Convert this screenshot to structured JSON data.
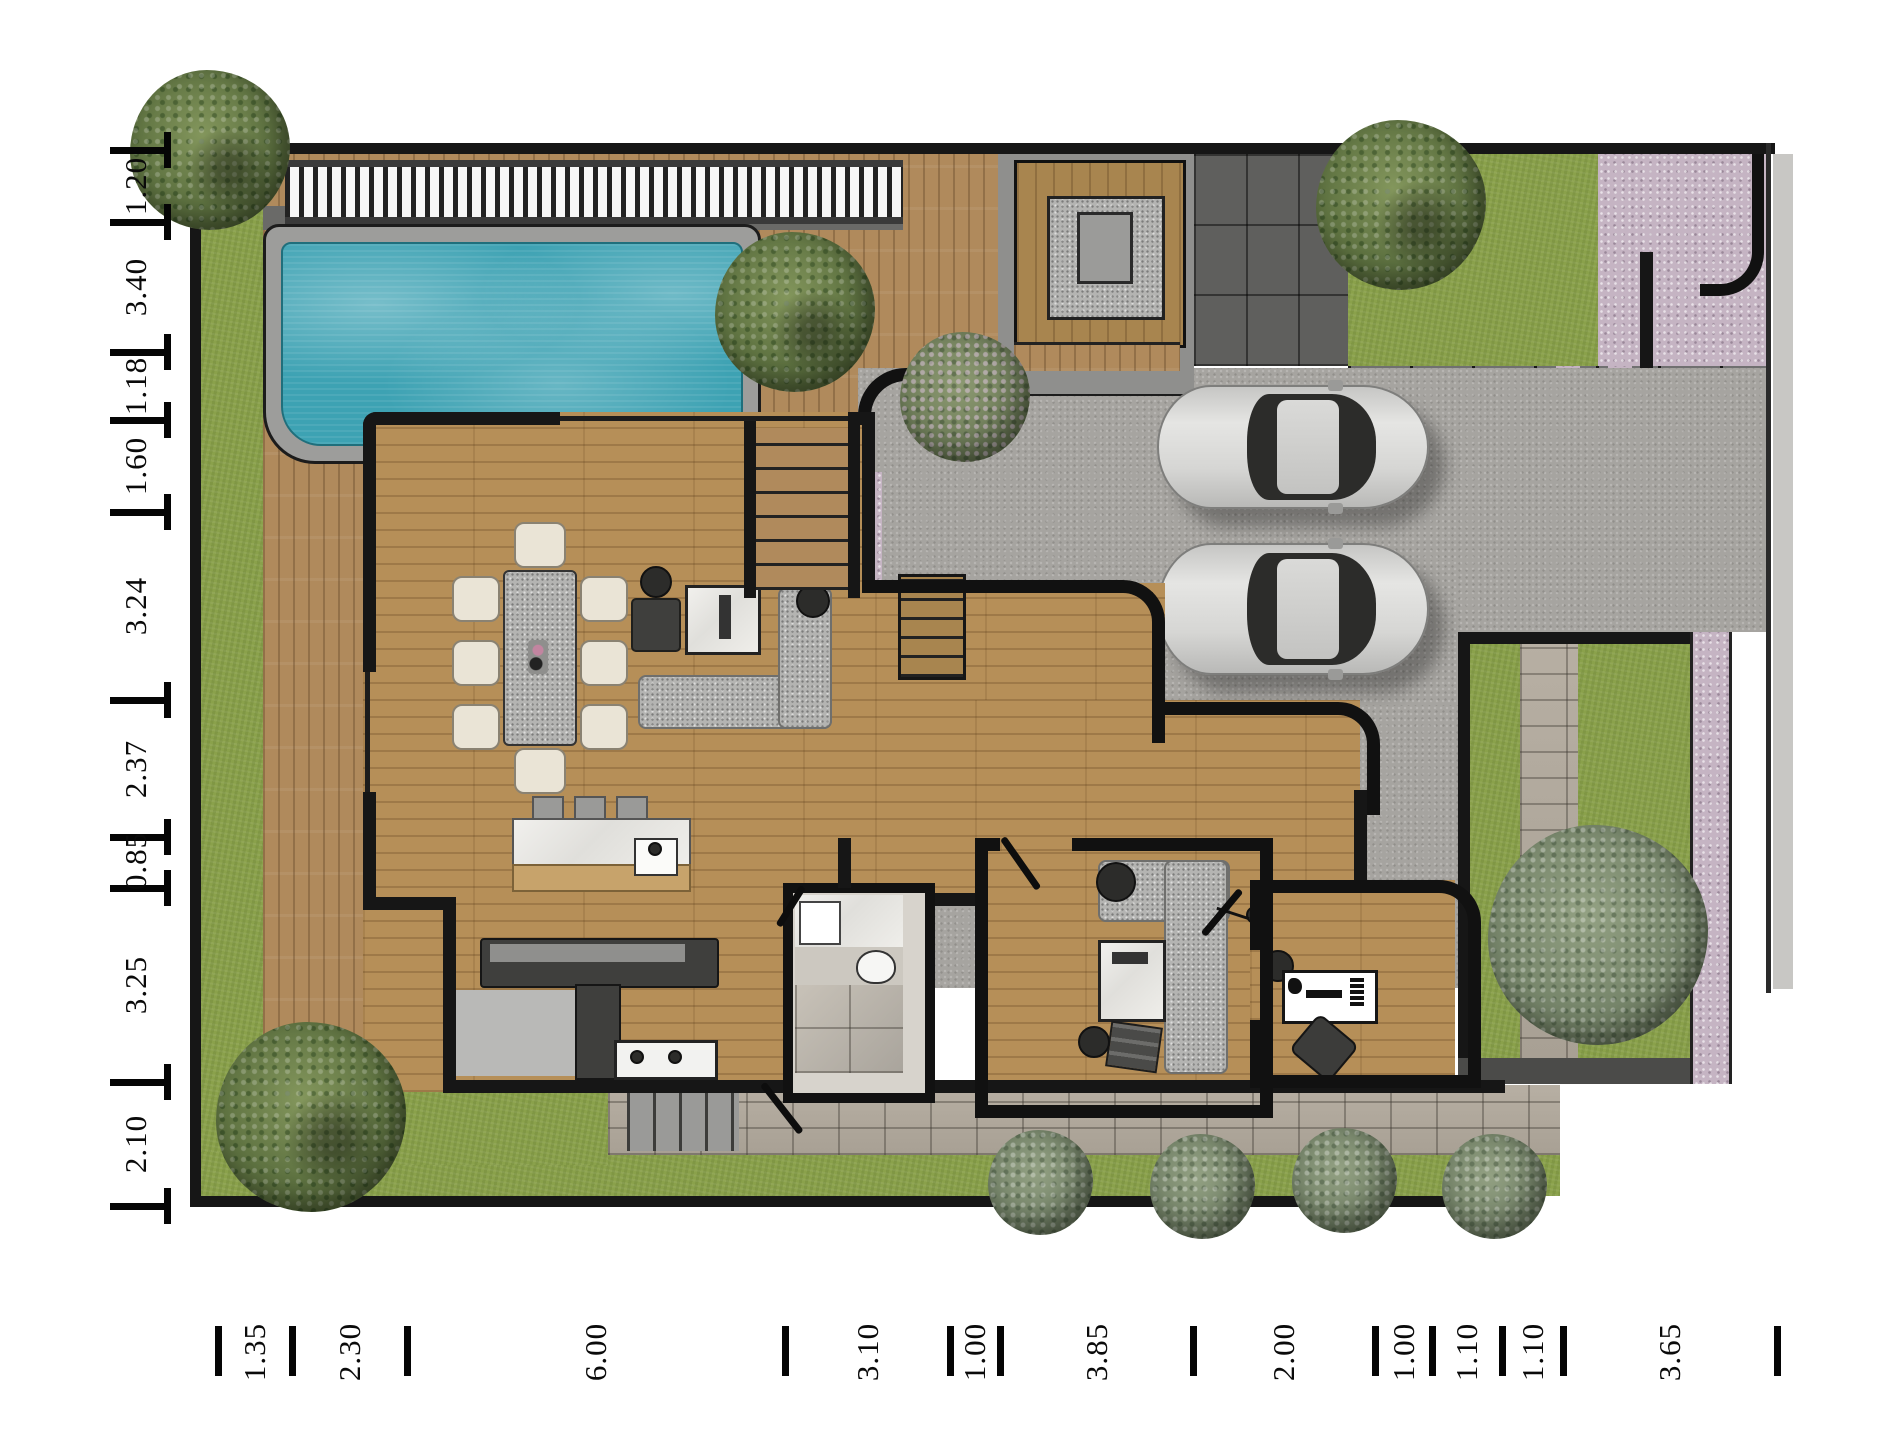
{
  "figure": {
    "type": "architectural-floor-plan",
    "description": "Top-view rendered villa floor plan with pool, deck, driveway, garden and furniture"
  },
  "dimensions": {
    "left": [
      "1.20",
      "3.40",
      "1.18",
      "1.60",
      "3.24",
      "2.37",
      "0.85",
      "3.25",
      "2.10"
    ],
    "bottom": [
      "1.35",
      "2.30",
      "6.00",
      "3.10",
      "1.00",
      "3.85",
      "2.00",
      "1.00",
      "1.10",
      "1.10",
      "3.65"
    ]
  },
  "colors": {
    "pool_water": "#3da2b3",
    "lawn": "#8aa14b",
    "deck_wood": "#b08a5c",
    "interior_wood": "#b68f58",
    "driveway": "#a6a4a0",
    "dark_pavers": "#5f5f5d",
    "pink_pavers": "#c5b4c3",
    "stone_path": "#b0a89c",
    "wall": "#161616",
    "marble": "#efeeea",
    "granite_fabric": "#b4b4b2"
  }
}
